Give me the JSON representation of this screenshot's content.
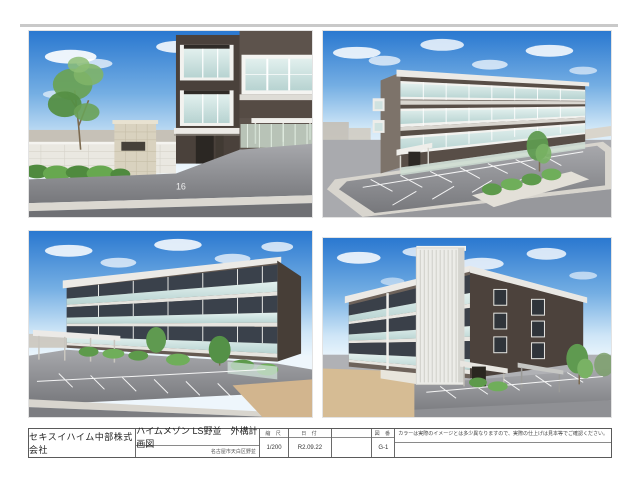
{
  "sheet": {
    "titleblock": {
      "company": "セキスイハイム中部株式会社",
      "title": "ハイムメゾン LS野並　外構計画図",
      "subtitle": "名古屋市天白区野並",
      "fields": [
        {
          "label": "縮 尺",
          "value": "1/200"
        },
        {
          "label": "日 付",
          "value": "R2.09.22"
        },
        {
          "label": "",
          "value": ""
        },
        {
          "label": "図 番",
          "value": "G-1"
        }
      ],
      "note": "カラーは実際のイメージとは多少異なりますので、実際の仕上げは見本等でご確認ください。"
    },
    "panels": [
      {
        "name": "entrance-street-view",
        "parking_number": "16"
      },
      {
        "name": "aerial-overview"
      },
      {
        "name": "front-elevation-view"
      },
      {
        "name": "corner-stair-view"
      }
    ],
    "colors": {
      "sky_top": "#2a78d0",
      "building_dark": "#554b45",
      "building_light_face": "#7d736a",
      "balcony_glass": "#cfe4e2",
      "fascia_white": "#eceae6",
      "asphalt": "#8f9093",
      "sidewalk": "#d9d6cf",
      "road_dark": "#6f7074",
      "greenery": "#5f9a4e",
      "dirt": "#d2b58e"
    }
  }
}
